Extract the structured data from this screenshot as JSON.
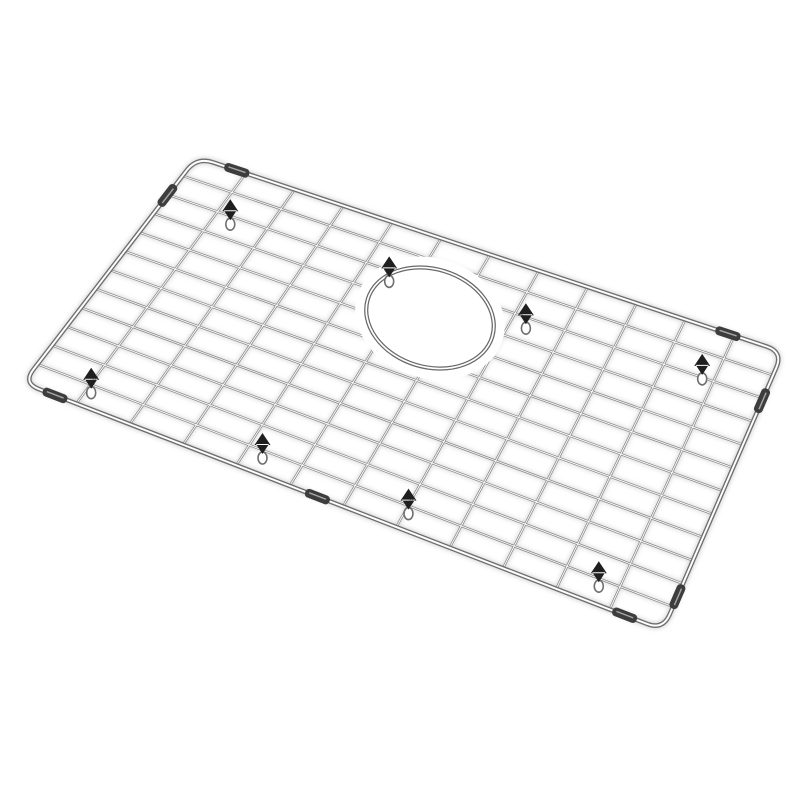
{
  "scene": {
    "alt": "Stainless steel kitchen sink bottom grid with round drain opening, rubber feet and protective edge clips, shown in perspective on a white background",
    "background_color": "#ffffff"
  },
  "grid_drawing": {
    "corners": {
      "tl": [
        197,
        157
      ],
      "tr": [
        783,
        352
      ],
      "br": [
        663,
        630
      ],
      "bl": [
        23,
        383
      ]
    },
    "corner_radius": 17,
    "rail_count": 11,
    "cross_count": 11,
    "wire_color": "#8a8a8a",
    "wire_core_color": "#ffffff",
    "frame_color": "#6e6e6e",
    "halo_color": "#9c9c9c",
    "hole": {
      "cx": 430,
      "cy": 318,
      "rx": 65,
      "ry": 49,
      "rotation": 17,
      "ring_color": "#686868",
      "clear_margin": 11
    },
    "feet": {
      "color": "#1f1f1f",
      "loop_color": "#6e6e6e",
      "positions_uv": [
        [
          0.1,
          0.15
        ],
        [
          0.37,
          0.16
        ],
        [
          0.6,
          0.16
        ],
        [
          0.89,
          0.13
        ],
        [
          0.08,
          0.9
        ],
        [
          0.35,
          0.9
        ],
        [
          0.58,
          0.9
        ],
        [
          0.88,
          0.9
        ]
      ]
    },
    "clips": {
      "color": "#3d3d3d",
      "positions": [
        {
          "edge": "top",
          "t": 0.068
        },
        {
          "edge": "top",
          "t": 0.906
        },
        {
          "edge": "left",
          "t": 0.17
        },
        {
          "edge": "right",
          "t": 0.175
        },
        {
          "edge": "right",
          "t": 0.88
        },
        {
          "edge": "bottom",
          "t": 0.05
        },
        {
          "edge": "bottom",
          "t": 0.46
        },
        {
          "edge": "bottom",
          "t": 0.94
        }
      ]
    }
  }
}
